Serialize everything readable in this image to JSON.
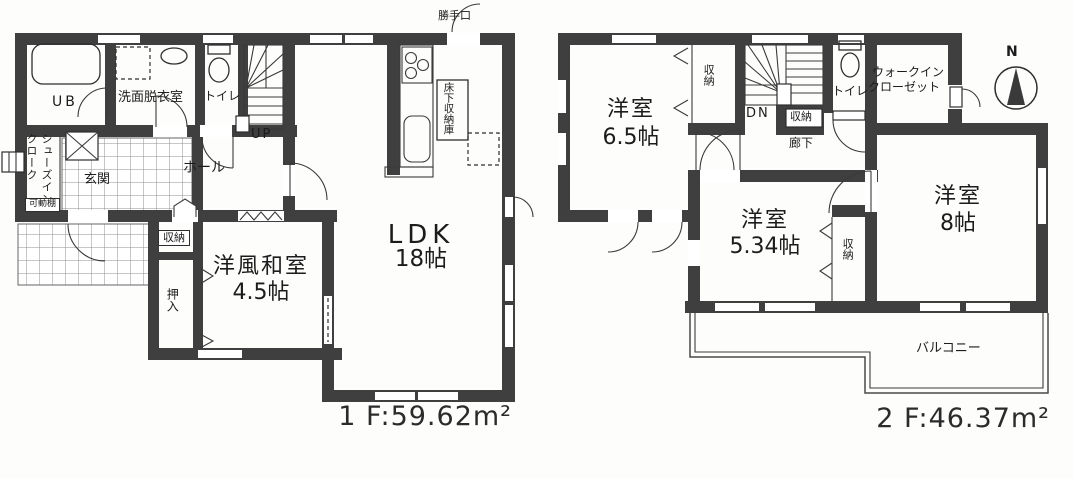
{
  "meta": {
    "drawing_type": "floor-plan",
    "wall_color": "#3f3f3f",
    "paper_color": "#fdfdfc"
  },
  "floor1": {
    "area_label": "1 F:59.62m²",
    "rooms": {
      "unit_bath": "UB",
      "washroom": "洗面脱衣室",
      "toilet": "トイレ",
      "stairs_up": "UP",
      "hall": "ホール",
      "entrance": "玄関",
      "shoes_in_cloak": "シューズインクローク",
      "movable_shelf": "可動棚",
      "storage": "収納",
      "oshiire": "押入",
      "japanese_room_name": "洋風和室",
      "japanese_room_size": "4.5帖",
      "ldk_name": "LDK",
      "ldk_size": "18帖",
      "underfloor_storage": "床下収納庫",
      "back_door": "勝手口"
    }
  },
  "floor2": {
    "area_label": "2 F:46.37m²",
    "rooms": {
      "bedroom1_name": "洋室",
      "bedroom1_size": "6.5帖",
      "bedroom2_name": "洋室",
      "bedroom2_size": "5.34帖",
      "bedroom3_name": "洋室",
      "bedroom3_size": "8帖",
      "closet_by_bedroom1": "収納",
      "closet_by_stairs": "収納",
      "closet_between_rooms": "収納",
      "stairs_down": "DN",
      "corridor": "廊下",
      "toilet": "トイレ",
      "walk_in_closet_line1": "ウォークイン",
      "walk_in_closet_line2": "クローゼット",
      "balcony": "バルコニー"
    }
  },
  "compass": {
    "north_label": "N"
  }
}
